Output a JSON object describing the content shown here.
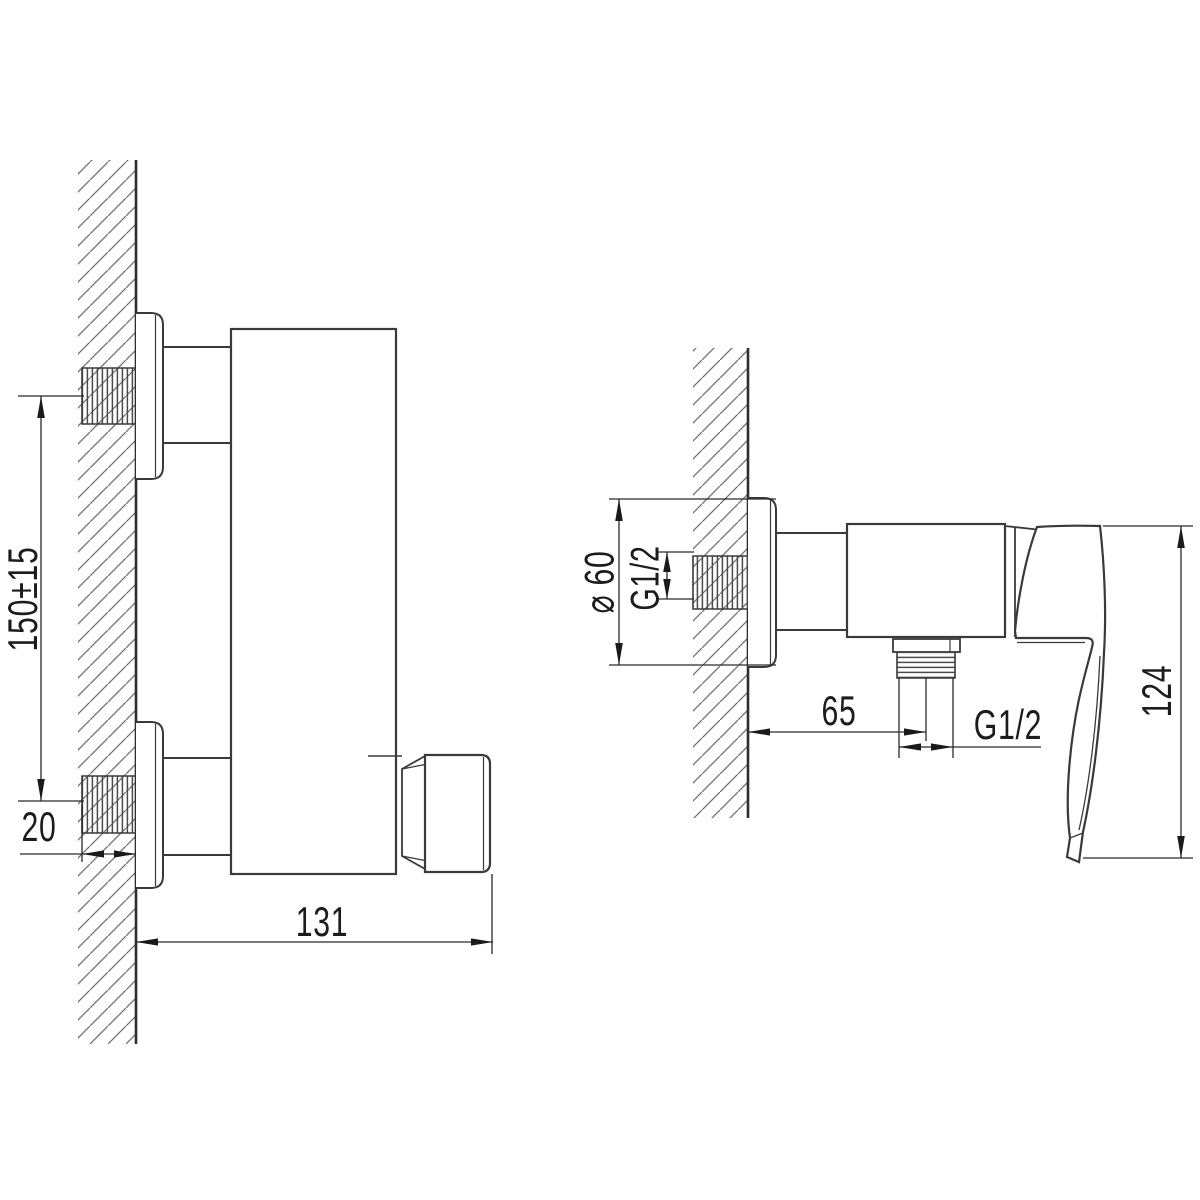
{
  "drawing": {
    "left_view": {
      "dimensions": {
        "inlet_spacing": "150±15",
        "thread_length": "20",
        "depth": "131"
      }
    },
    "right_view": {
      "dimensions": {
        "escutcheon_diameter": "⌀ 60",
        "inlet_thread": "G1/2",
        "outlet_offset": "65",
        "outlet_thread": "G1/2",
        "handle_length": "124"
      }
    },
    "colors": {
      "background": "#ffffff",
      "geometry_line": "#3a3a3a",
      "dimension_line": "#2a2a2a",
      "hatch_line": "#707070",
      "text": "#1c1c1c"
    }
  }
}
